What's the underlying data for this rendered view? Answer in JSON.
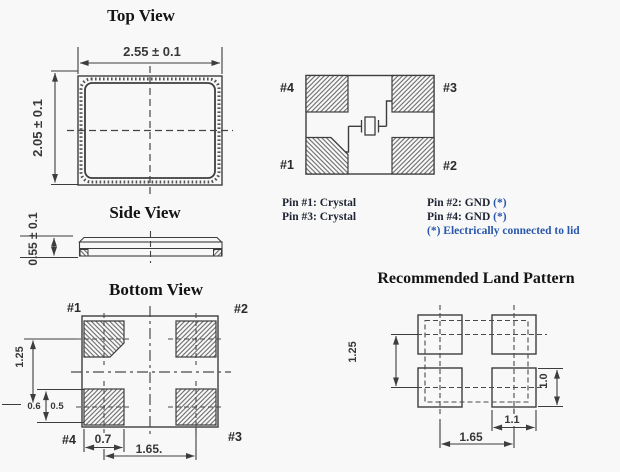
{
  "colors": {
    "background": "#f8f8f8",
    "line": "#3d3d3d",
    "hatch": "#6a6a6a",
    "text_dark": "#1e2433",
    "text_blue": "#2a57ad",
    "title": "#141414"
  },
  "titles": {
    "top_view": "Top View",
    "side_view": "Side View",
    "bottom_view": "Bottom View",
    "land_pattern": "Recommended Land Pattern"
  },
  "top_view": {
    "width_dim": "2.55 ± 0.1",
    "height_dim": "2.05 ± 0.1"
  },
  "side_view": {
    "height_dim": "0.55 ± 0.1"
  },
  "schematic": {
    "pin1": "#1",
    "pin2": "#2",
    "pin3": "#3",
    "pin4": "#4"
  },
  "pin_functions": {
    "pin1": "Pin #1: Crystal",
    "pin3": "Pin #3: Crystal",
    "pin2_label": "Pin #2: GND",
    "pin2_star": " (*)",
    "pin4_label": "Pin #4: GND",
    "pin4_star": " (*)",
    "note": "(*) Electrically connected to lid"
  },
  "bottom_view": {
    "pin1": "#1",
    "pin2": "#2",
    "pin3": "#3",
    "pin4": "#4",
    "dim_row_pitch": "1.25",
    "dim_left": "0.6",
    "dim_pad_height": "0.5",
    "dim_pad_width": "0.7",
    "dim_col_pitch": "1.65."
  },
  "land_pattern": {
    "dim_row_pitch": "1.25",
    "dim_pad_height": "1.0",
    "dim_pad_width": "1.1",
    "dim_col_pitch": "1.65"
  }
}
